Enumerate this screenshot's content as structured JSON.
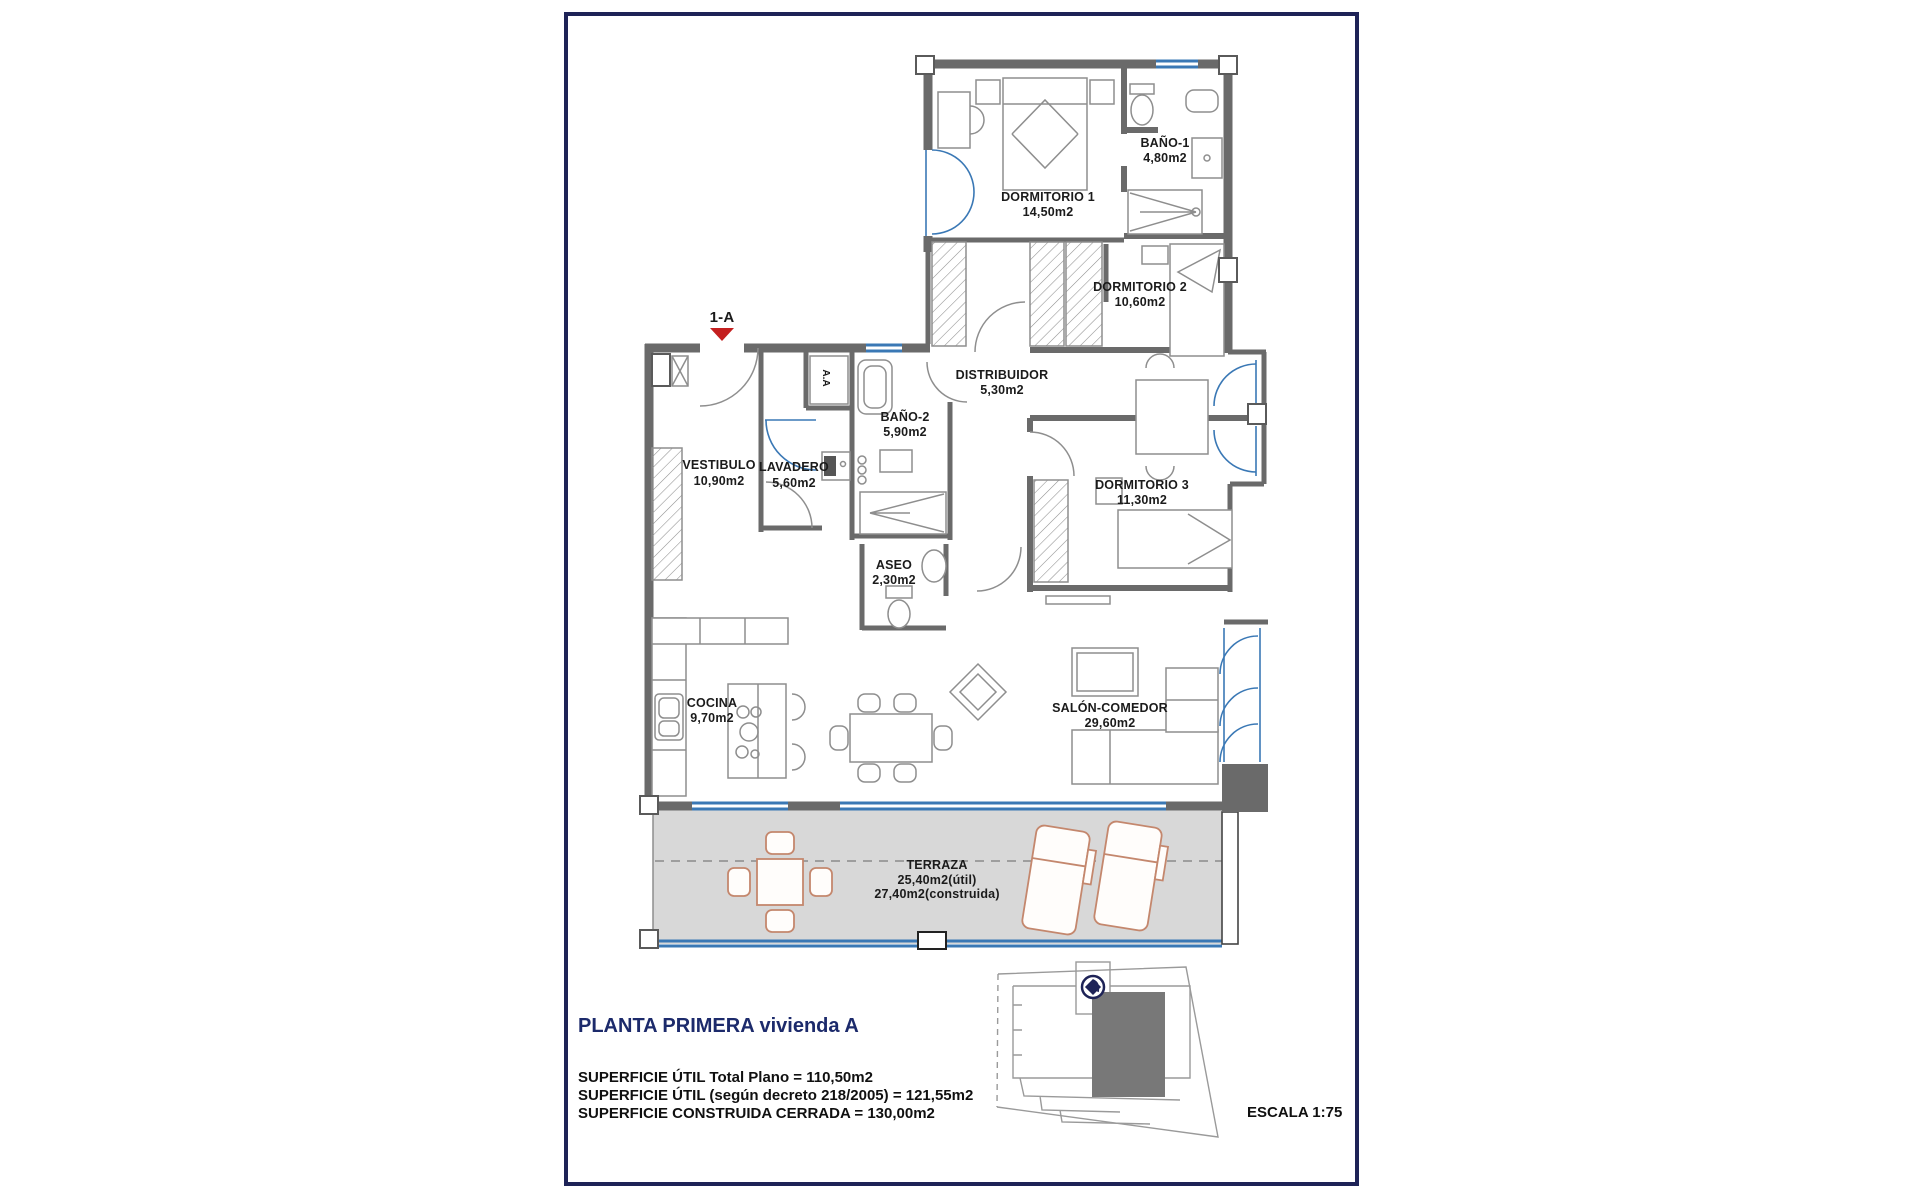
{
  "plan": {
    "unit_marker": "1-A",
    "ac_label": "A.A",
    "rooms": [
      {
        "name": "DORMITORIO 1",
        "area": "14,50m2"
      },
      {
        "name": "BAÑO-1",
        "area": "4,80m2"
      },
      {
        "name": "DORMITORIO 2",
        "area": "10,60m2"
      },
      {
        "name": "DISTRIBUIDOR",
        "area": "5,30m2"
      },
      {
        "name": "BAÑO-2",
        "area": "5,90m2"
      },
      {
        "name": "VESTIBULO",
        "area": "10,90m2"
      },
      {
        "name": "LAVADERO",
        "area": "5,60m2"
      },
      {
        "name": "ASEO",
        "area": "2,30m2"
      },
      {
        "name": "DORMITORIO 3",
        "area": "11,30m2"
      },
      {
        "name": "COCINA",
        "area": "9,70m2"
      },
      {
        "name": "SALÓN-COMEDOR",
        "area": "29,60m2"
      },
      {
        "name": "TERRAZA",
        "area_util": "25,40m2(útil)",
        "area_construida": "27,40m2(construida)"
      }
    ]
  },
  "footer": {
    "title": "PLANTA PRIMERA vivienda A",
    "surface_lines": [
      "SUPERFICIE ÚTIL Total Plano = 110,50m2",
      "SUPERFICIE ÚTIL (según decreto 218/2005) = 121,55m2",
      "SUPERFICIE CONSTRUIDA CERRADA = 130,00m2"
    ],
    "scale": "ESCALA 1:75"
  },
  "colors": {
    "border_navy": "#1e2357",
    "wall_gray": "#6a6a6a",
    "terrace_gray": "#d8d8d8",
    "glazing_blue": "#3a78b5",
    "furniture_salmon": "#c4876d",
    "marker_red": "#c41f1f"
  }
}
